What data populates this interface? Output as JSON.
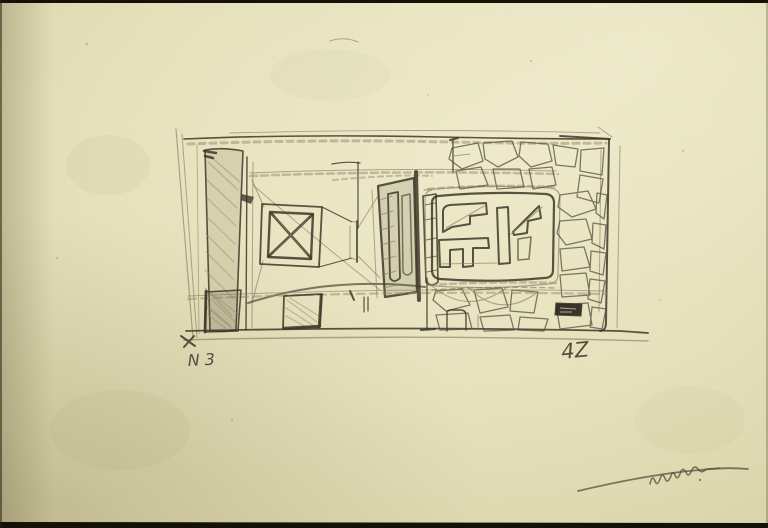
{
  "artwork": {
    "medium": "pencil sketch on aged yellowed paper (scanned photograph)",
    "subject": "abstract constructivist plan: hatched column, crossed square, dark portal, panel of glyph shapes, crazy-stone paving",
    "annotations": {
      "bottom_left": "N 3",
      "bottom_right": "4Z"
    },
    "signature_note": "illegible pencil signature with long underline stroke, lower right corner",
    "colors": {
      "paper": "#e9e4bf",
      "paper_edge": "#d2cba0",
      "pencil_dark": "#3e3729",
      "pencil_light": "#837b5e",
      "photo_border": "#141109",
      "label_block": "#2b2720",
      "label_marks": "#cfc89b"
    }
  }
}
